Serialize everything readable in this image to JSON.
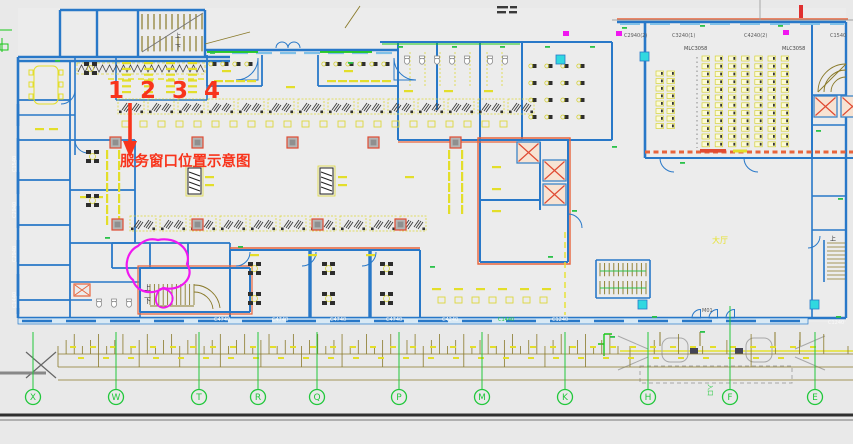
{
  "canvas": {
    "w": 853,
    "h": 444
  },
  "palette": {
    "bg": "#e9e9e9",
    "wall": "#2878c8",
    "wall_light": "#7fc0e8",
    "accent": "#e8643c",
    "cad_yellow": "#e6e22c",
    "cad_green": "#22c83c",
    "cad_olive": "#8a7a2a",
    "magenta": "#f018f0",
    "annotation_red": "#f8341c",
    "cyan": "#30d8e0",
    "dark": "#2d2d2d"
  },
  "annotation": {
    "numbers": "1 2 3 4",
    "caption": "服务窗口位置示意图"
  },
  "grid_bubbles": [
    {
      "label": "X",
      "x": 33
    },
    {
      "label": "W",
      "x": 116
    },
    {
      "label": "T",
      "x": 199
    },
    {
      "label": "R",
      "x": 258
    },
    {
      "label": "Q",
      "x": 317
    },
    {
      "label": "P",
      "x": 399
    },
    {
      "label": "M",
      "x": 482
    },
    {
      "label": "K",
      "x": 565
    },
    {
      "label": "H",
      "x": 648
    },
    {
      "label": "F",
      "x": 730,
      "y0": 306
    },
    {
      "label": "E",
      "x": 815
    }
  ],
  "labels": [
    {
      "t": "C4740",
      "x": 214,
      "y": 321,
      "s": 5,
      "c": "#fafafa"
    },
    {
      "t": "C4740",
      "x": 272,
      "y": 321,
      "s": 5,
      "c": "#fafafa"
    },
    {
      "t": "C4740",
      "x": 330,
      "y": 321,
      "s": 5,
      "c": "#fafafa"
    },
    {
      "t": "C4740",
      "x": 386,
      "y": 321,
      "s": 5,
      "c": "#fafafa"
    },
    {
      "t": "C4240",
      "x": 442,
      "y": 321,
      "s": 5,
      "c": "#fafafa"
    },
    {
      "t": "C1440",
      "x": 498,
      "y": 321,
      "s": 5,
      "c": "#22c83c"
    },
    {
      "t": "C1240",
      "x": 552,
      "y": 321,
      "s": 5,
      "c": "#fafafa"
    },
    {
      "t": "C1240",
      "x": 828,
      "y": 324,
      "s": 5,
      "c": "#fafafa"
    },
    {
      "t": "C1540",
      "x": 16,
      "y": 172,
      "s": 5,
      "c": "#fafafa",
      "r": -90
    },
    {
      "t": "C2940",
      "x": 16,
      "y": 218,
      "s": 5,
      "c": "#fafafa",
      "r": -90
    },
    {
      "t": "C2940",
      "x": 16,
      "y": 262,
      "s": 5,
      "c": "#fafafa",
      "r": -90
    },
    {
      "t": "C1440",
      "x": 16,
      "y": 308,
      "s": 5,
      "c": "#fafafa",
      "r": -90
    },
    {
      "t": "C2940(2)",
      "x": 624,
      "y": 37,
      "s": 5,
      "c": "#5a5a5a"
    },
    {
      "t": "C3240(1)",
      "x": 672,
      "y": 37,
      "s": 5,
      "c": "#5a5a5a"
    },
    {
      "t": "C4240(2)",
      "x": 744,
      "y": 37,
      "s": 5,
      "c": "#5a5a5a"
    },
    {
      "t": "C1540",
      "x": 830,
      "y": 37,
      "s": 5,
      "c": "#5a5a5a"
    },
    {
      "t": "MLC3058",
      "x": 684,
      "y": 50,
      "s": 5,
      "c": "#444444"
    },
    {
      "t": "MLC3058",
      "x": 782,
      "y": 50,
      "s": 5,
      "c": "#444444"
    },
    {
      "t": "上",
      "x": 144,
      "y": 290,
      "s": 7,
      "c": "#333333"
    },
    {
      "t": "下",
      "x": 144,
      "y": 303,
      "s": 7,
      "c": "#333333"
    },
    {
      "t": "上",
      "x": 175,
      "y": 38,
      "s": 6,
      "c": "#333333"
    },
    {
      "t": "下",
      "x": 175,
      "y": 49,
      "s": 6,
      "c": "#333333"
    },
    {
      "t": "上",
      "x": 830,
      "y": 241,
      "s": 6,
      "c": "#333333"
    },
    {
      "t": "M01",
      "x": 702,
      "y": 312,
      "s": 5,
      "c": "#555555"
    },
    {
      "t": "大厅",
      "x": 712,
      "y": 243,
      "s": 8,
      "c": "#e6e22c"
    },
    {
      "t": "入口",
      "x": 708,
      "y": 384,
      "s": 6,
      "c": "#22c83c",
      "r": 90
    }
  ],
  "plan": {
    "grids": [
      {
        "sym": "counter",
        "x": 118,
        "y": 99,
        "cols": 14,
        "rows": 1,
        "dx": 30,
        "dy": 0
      },
      {
        "sym": "counter",
        "x": 130,
        "y": 216,
        "cols": 10,
        "rows": 1,
        "dx": 30,
        "dy": 0
      },
      {
        "sym": "qsq",
        "x": 122,
        "y": 121,
        "cols": 22,
        "rows": 1,
        "dx": 18,
        "dy": 0
      },
      {
        "sym": "qsq",
        "x": 438,
        "y": 297,
        "cols": 7,
        "rows": 1,
        "dx": 17,
        "dy": 0
      },
      {
        "sym": "seat",
        "x": 702,
        "y": 56,
        "cols": 7,
        "rows": 12,
        "dx": 13.2,
        "dy": 7.8
      },
      {
        "sym": "seat",
        "x": 656,
        "y": 71,
        "cols": 2,
        "rows": 8,
        "dx": 11,
        "dy": 7.5
      },
      {
        "sym": "mseat",
        "x": 532,
        "y": 64,
        "cols": 4,
        "rows": 4,
        "dx": 16,
        "dy": 17
      },
      {
        "sym": "mseat",
        "x": 212,
        "y": 62,
        "cols": 4,
        "rows": 1,
        "dx": 12,
        "dy": 0
      },
      {
        "sym": "mseat",
        "x": 325,
        "y": 62,
        "cols": 6,
        "rows": 1,
        "dx": 12,
        "dy": 0
      },
      {
        "sym": "ydash",
        "x": 122,
        "y": 62,
        "cols": 4,
        "rows": 6,
        "dx": 22,
        "dy": 5.8
      },
      {
        "sym": "ydash",
        "x": 250,
        "y": 254,
        "cols": 3,
        "rows": 1,
        "dx": 58,
        "dy": 0
      },
      {
        "sym": "ydash",
        "x": 404,
        "y": 90,
        "cols": 3,
        "rows": 1,
        "dx": 40,
        "dy": 0
      },
      {
        "sym": "ydash",
        "x": 214,
        "y": 80,
        "cols": 4,
        "rows": 1,
        "dx": 11,
        "dy": 0
      },
      {
        "sym": "ydash",
        "x": 327,
        "y": 80,
        "cols": 6,
        "rows": 1,
        "dx": 11,
        "dy": 0
      },
      {
        "sym": "ydash",
        "x": 222,
        "y": 70,
        "cols": 1,
        "rows": 1,
        "dx": 0,
        "dy": 0
      },
      {
        "sym": "ydash",
        "x": 344,
        "y": 70,
        "cols": 1,
        "rows": 1,
        "dx": 0,
        "dy": 0
      },
      {
        "sym": "ydash",
        "x": 286,
        "y": 86,
        "cols": 1,
        "rows": 1,
        "dx": 0,
        "dy": 0
      },
      {
        "sym": "ydash",
        "x": 205,
        "y": 176,
        "cols": 1,
        "rows": 2,
        "dx": 0,
        "dy": 8
      },
      {
        "sym": "ydash",
        "x": 338,
        "y": 176,
        "cols": 1,
        "rows": 2,
        "dx": 0,
        "dy": 8
      },
      {
        "sym": "ydash",
        "x": 405,
        "y": 176,
        "cols": 1,
        "rows": 1,
        "dx": 0,
        "dy": 0
      },
      {
        "sym": "ydash",
        "x": 432,
        "y": 288,
        "cols": 6,
        "rows": 1,
        "dx": 22,
        "dy": 0
      },
      {
        "sym": "ydash",
        "x": 492,
        "y": 166,
        "cols": 1,
        "rows": 3,
        "dx": 0,
        "dy": 22
      },
      {
        "sym": "ydash",
        "x": 35,
        "y": 128,
        "cols": 2,
        "rows": 1,
        "dx": 14,
        "dy": 0
      },
      {
        "sym": "ydash",
        "x": 80,
        "y": 196,
        "cols": 2,
        "rows": 1,
        "dx": 14,
        "dy": 0
      },
      {
        "sym": "yvdash",
        "x": 448,
        "y": 150,
        "cols": 2,
        "rows": 6,
        "dx": 13,
        "dy": 11
      },
      {
        "sym": "yvdash",
        "x": 106,
        "y": 150,
        "cols": 2,
        "rows": 7,
        "dx": 12,
        "dy": 11
      },
      {
        "sym": "ynum",
        "x": 70,
        "y": 346,
        "cols": 38,
        "rows": 1,
        "dx": 20,
        "dy": 0
      },
      {
        "sym": "ynum",
        "x": 78,
        "y": 357,
        "cols": 30,
        "rows": 1,
        "dx": 25,
        "dy": 0
      }
    ],
    "points": {
      "column": [
        [
          110,
          137
        ],
        [
          192,
          137
        ],
        [
          287,
          137
        ],
        [
          368,
          137
        ],
        [
          450,
          137
        ],
        [
          112,
          219
        ],
        [
          192,
          219
        ],
        [
          312,
          219
        ],
        [
          395,
          219
        ]
      ],
      "elev": [
        [
          517,
          142
        ],
        [
          543,
          160
        ],
        [
          543,
          184
        ],
        [
          814,
          96
        ],
        [
          841,
          96
        ]
      ],
      "wc": [
        [
          404,
          56
        ],
        [
          419,
          56
        ],
        [
          434,
          56
        ],
        [
          449,
          56
        ],
        [
          464,
          56
        ],
        [
          487,
          56
        ],
        [
          502,
          56
        ],
        [
          96,
          299
        ],
        [
          111,
          299
        ],
        [
          126,
          299
        ]
      ],
      "deskpair": [
        [
          86,
          150
        ],
        [
          86,
          194
        ],
        [
          248,
          262
        ],
        [
          248,
          292
        ],
        [
          322,
          262
        ],
        [
          322,
          292
        ],
        [
          380,
          262
        ],
        [
          380,
          292
        ],
        [
          84,
          62
        ]
      ],
      "gdash": [
        [
          398,
          46
        ],
        [
          452,
          46
        ],
        [
          500,
          46
        ],
        [
          545,
          46
        ],
        [
          590,
          46
        ],
        [
          622,
          27
        ],
        [
          700,
          25
        ],
        [
          778,
          25
        ],
        [
          612,
          146
        ],
        [
          572,
          210
        ],
        [
          548,
          256
        ],
        [
          430,
          266
        ],
        [
          238,
          246
        ],
        [
          105,
          237
        ],
        [
          680,
          162
        ],
        [
          816,
          130
        ],
        [
          838,
          198
        ],
        [
          652,
          316
        ],
        [
          700,
          331
        ],
        [
          610,
          336
        ],
        [
          836,
          316
        ],
        [
          348,
          62
        ],
        [
          210,
          52
        ],
        [
          55,
          60
        ]
      ],
      "mgdoor": [
        [
          563,
          31
        ],
        [
          616,
          31
        ],
        [
          783,
          30
        ]
      ],
      "cyanbox": [
        [
          556,
          55
        ],
        [
          640,
          52
        ],
        [
          638,
          300
        ],
        [
          810,
          300
        ]
      ]
    }
  },
  "dim_band": {
    "y_line1": 354,
    "y_line2": 367,
    "y_line3": 380,
    "bubble_y": 397,
    "y0_default": 332,
    "segments": [
      {
        "x0": 58,
        "x1": 618,
        "n": 70
      },
      {
        "x0": 630,
        "x1": 848,
        "n": 10
      }
    ]
  }
}
